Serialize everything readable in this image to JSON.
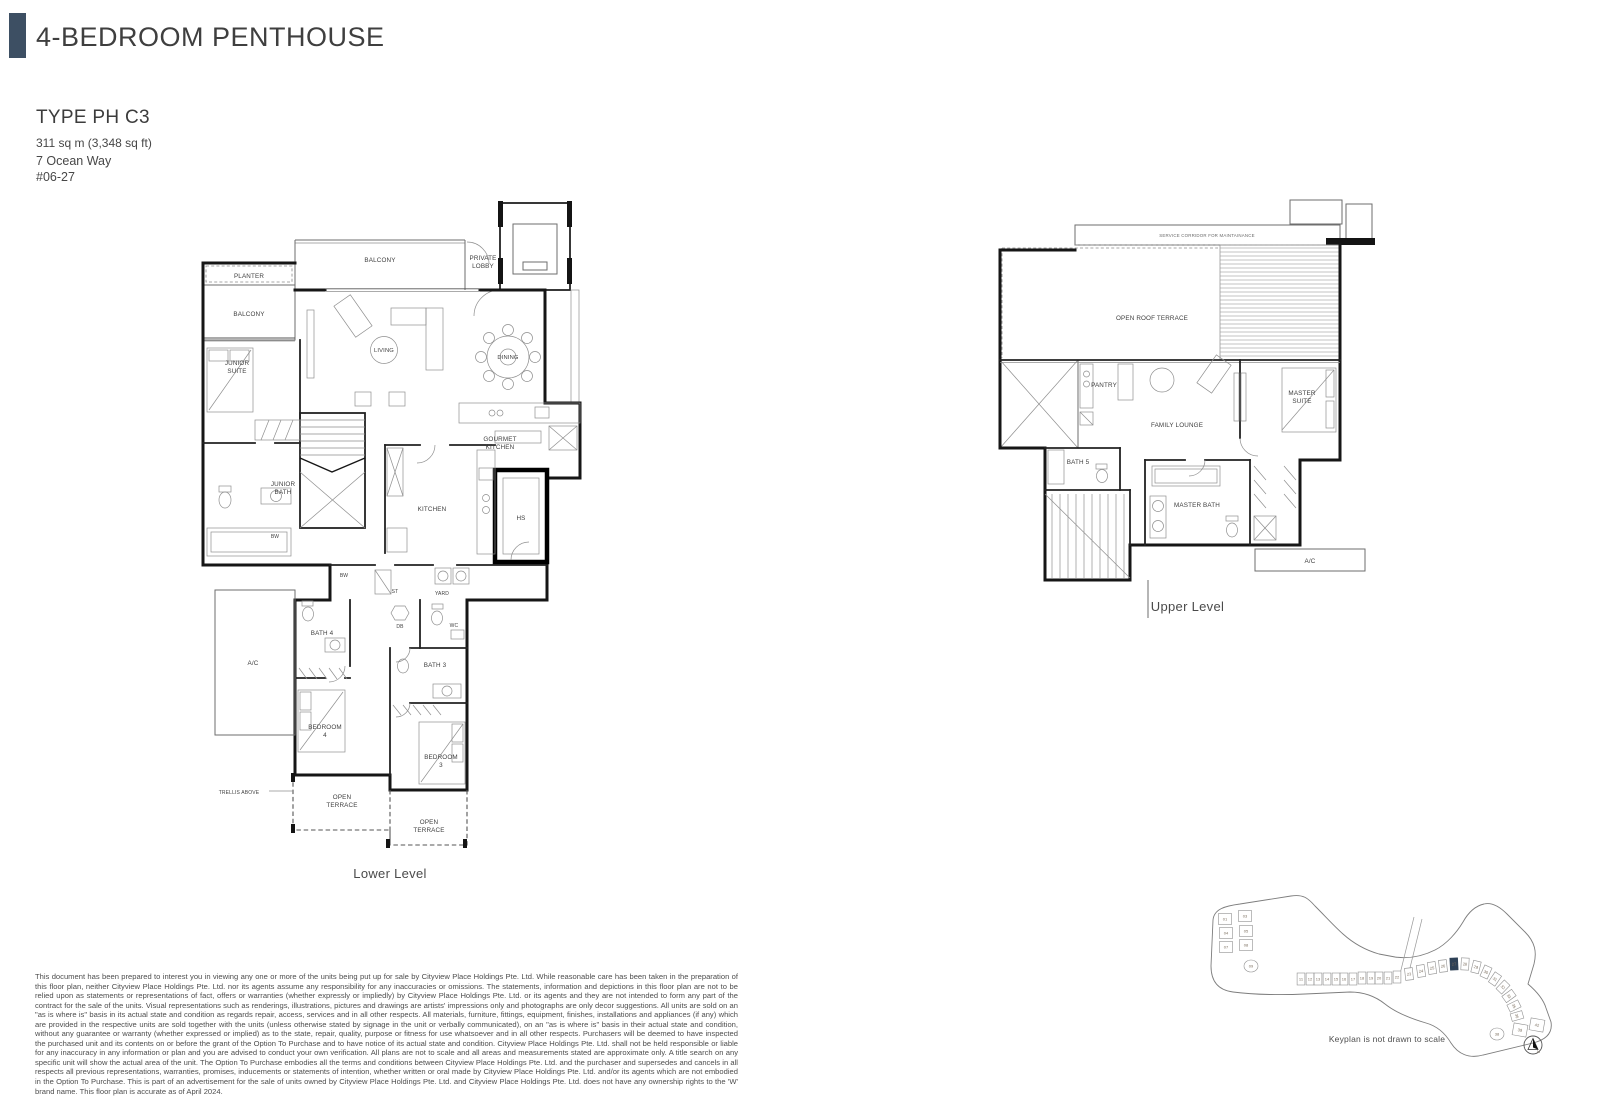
{
  "header": {
    "title": "4-BEDROOM PENTHOUSE"
  },
  "unit": {
    "type_label": "TYPE PH C3",
    "area": "311 sq m (3,348 sq ft)",
    "address": "7 Ocean Way",
    "unit_number": "#06-27"
  },
  "colors": {
    "accent_bar": "#3d4f63",
    "walls": "#161616",
    "keyplan_highlight": "#2e4156"
  },
  "plans": {
    "lower": {
      "caption": "Lower Level",
      "labels": {
        "balcony_top": "BALCONY",
        "planter": "PLANTER",
        "balcony_left": "BALCONY",
        "private_l1": "PRIVATE",
        "private_l2": "LOBBY",
        "junior_suite_l1": "JUNIOR",
        "junior_suite_l2": "SUITE",
        "living": "LIVING",
        "dining": "DINING",
        "gourmet_l1": "GOURMET",
        "gourmet_l2": "KITCHEN",
        "junior_bath_l1": "JUNIOR",
        "junior_bath_l2": "BATH",
        "bw1": "BW",
        "bw2": "BW",
        "kitchen": "KITCHEN",
        "hs": "HS",
        "st": "ST",
        "yard": "YARD",
        "db": "DB",
        "wc": "WC",
        "bath4": "BATH 4",
        "bath3": "BATH 3",
        "ac": "A/C",
        "bedroom4_l1": "BEDROOM",
        "bedroom4_l2": "4",
        "bedroom3_l1": "BEDROOM",
        "bedroom3_l2": "3",
        "trellis": "TRELLIS ABOVE",
        "terrace1_l1": "OPEN",
        "terrace1_l2": "TERRACE",
        "terrace2_l1": "OPEN",
        "terrace2_l2": "TERRACE"
      }
    },
    "upper": {
      "caption": "Upper Level",
      "labels": {
        "service_corridor": "SERVICE CORRIDOR FOR MAINTAINANCE",
        "open_roof_terrace": "OPEN ROOF TERRACE",
        "pantry": "PANTRY",
        "family_lounge": "FAMILY LOUNGE",
        "master_l1": "MASTER",
        "master_l2": "SUITE",
        "bath5": "BATH 5",
        "master_bath": "MASTER BATH",
        "ac": "A/C"
      }
    }
  },
  "keyplan": {
    "caption": "Keyplan is not drawn to scale",
    "highlighted_unit": "27",
    "highlight_color": "#2e4156",
    "north_label": "N",
    "units": [
      {
        "label": "01",
        "x": 30,
        "y": 37,
        "w": 13,
        "h": 11
      },
      {
        "label": "03",
        "x": 50,
        "y": 34,
        "w": 13,
        "h": 11
      },
      {
        "label": "04",
        "x": 31,
        "y": 51,
        "w": 13,
        "h": 11
      },
      {
        "label": "05",
        "x": 51,
        "y": 49,
        "w": 13,
        "h": 11
      },
      {
        "label": "07",
        "x": 31,
        "y": 65,
        "w": 13,
        "h": 11
      },
      {
        "label": "08",
        "x": 51,
        "y": 63,
        "w": 13,
        "h": 11
      },
      {
        "label": "09",
        "x": 56,
        "y": 84,
        "shape": "round"
      },
      {
        "label": "11",
        "x": 106,
        "y": 97
      },
      {
        "label": "12",
        "x": 115,
        "y": 97
      },
      {
        "label": "13",
        "x": 123,
        "y": 97
      },
      {
        "label": "14",
        "x": 132,
        "y": 97
      },
      {
        "label": "15",
        "x": 141,
        "y": 97
      },
      {
        "label": "16",
        "x": 149,
        "y": 97
      },
      {
        "label": "17",
        "x": 158,
        "y": 97
      },
      {
        "label": "18",
        "x": 167,
        "y": 96
      },
      {
        "label": "19",
        "x": 176,
        "y": 96
      },
      {
        "label": "20",
        "x": 184,
        "y": 96
      },
      {
        "label": "21",
        "x": 193,
        "y": 96
      },
      {
        "label": "22",
        "x": 202,
        "y": 95
      },
      {
        "label": "23",
        "x": 214,
        "y": 92,
        "r": -6
      },
      {
        "label": "24",
        "x": 226,
        "y": 89,
        "r": -8
      },
      {
        "label": "25",
        "x": 237,
        "y": 86,
        "r": -8
      },
      {
        "label": "26",
        "x": 248,
        "y": 84,
        "r": -6
      },
      {
        "label": "27",
        "x": 259,
        "y": 82,
        "r": -3,
        "hl": true
      },
      {
        "label": "28",
        "x": 270,
        "y": 82,
        "r": 3
      },
      {
        "label": "29",
        "x": 281,
        "y": 85,
        "r": 14
      },
      {
        "label": "30",
        "x": 291,
        "y": 90,
        "r": 24
      },
      {
        "label": "31",
        "x": 300,
        "y": 97,
        "r": 34
      },
      {
        "label": "32",
        "x": 308,
        "y": 105,
        "r": 44
      },
      {
        "label": "33",
        "x": 314,
        "y": 114,
        "r": 54
      },
      {
        "label": "35",
        "x": 319,
        "y": 124,
        "r": 64
      },
      {
        "label": "36",
        "x": 322,
        "y": 134,
        "r": 74
      },
      {
        "label": "38",
        "x": 302,
        "y": 152,
        "shape": "round"
      },
      {
        "label": "39",
        "x": 325,
        "y": 148,
        "r": 10,
        "w": 14,
        "h": 12
      },
      {
        "label": "42",
        "x": 342,
        "y": 143,
        "r": 10,
        "w": 14,
        "h": 12
      }
    ]
  },
  "disclaimer": "This document has been prepared to interest you in viewing any one or more of the units being put up for sale by Cityview Place Holdings Pte. Ltd. While reasonable care has been taken in the preparation of this floor plan, neither Cityview Place Holdings Pte. Ltd. nor its agents assume any responsibility for any inaccuracies or omissions. The statements, information and depictions in this floor plan are not to be relied upon as statements or representations of fact, offers or warranties (whether expressly or impliedly) by Cityview Place Holdings Pte. Ltd. or its agents and they are not intended to form any part of the contract for the sale of the units. Visual representations such as renderings, illustrations, pictures and drawings are artists' impressions only and photographs are only decor suggestions. All units are sold on an \"as is where is\" basis in its actual state and condition as regards repair, access, services and in all other respects. All materials, furniture, fittings, equipment, finishes, installations and appliances (if any) which are provided in the respective units are sold together with the units (unless otherwise stated by signage in the unit or verbally communicated), on an \"as is where is\" basis in their actual state and condition, without any guarantee or warranty (whether expressed or implied) as to the state, repair, quality, purpose or fitness for use whatsoever and in all other respects. Purchasers will be deemed to have inspected the purchased unit and its contents on or before the grant of the Option To Purchase and to have notice of its actual state and condition. Cityview Place Holdings Pte. Ltd. shall not be held responsible or liable for any inaccuracy in any information or plan and you are advised to conduct your own verification. All plans are not to scale and all areas and measurements stated are approximate only. A title search on any specific unit will show the actual area of the unit. The Option To Purchase embodies all the terms and conditions between Cityview Place Holdings Pte. Ltd. and the purchaser and supersedes and cancels in all respects all previous representations, warranties, promises, inducements or statements of intention, whether written or oral made by Cityview Place Holdings Pte. Ltd. and/or its agents which are not embodied in the Option To Purchase. This is part of an advertisement for the sale of units owned by Cityview Place Holdings Pte. Ltd. and Cityview Place Holdings Pte. Ltd. does not have any ownership rights to the 'W' brand name. This floor plan is accurate as of April 2024."
}
